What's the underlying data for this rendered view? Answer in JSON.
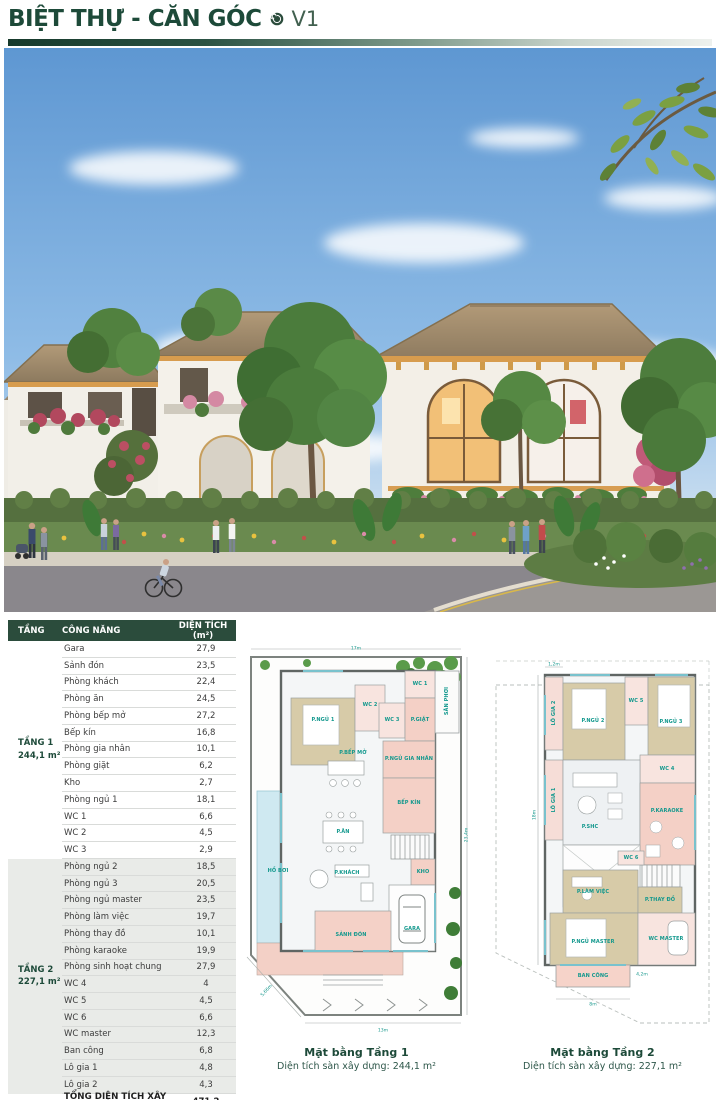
{
  "header": {
    "title": "BIỆT THỰ - CĂN GÓC",
    "version": "V1",
    "logo_icon": "spiral-icon"
  },
  "colors": {
    "brand_green": "#1d4a39",
    "table_header_bg": "#2b4c3c",
    "tang2_row_bg": "#e9ebe8",
    "plan_label_teal": "#12988d",
    "sky_blue": "#6ea6da"
  },
  "table": {
    "columns": [
      "TẦNG",
      "CÔNG NĂNG",
      "DIỆN TÍCH (m²)"
    ],
    "groups": [
      {
        "label": "TẦNG 1",
        "area": "244,1 m²",
        "rows": [
          [
            "Gara",
            "27,9"
          ],
          [
            "Sảnh đón",
            "23,5"
          ],
          [
            "Phòng khách",
            "22,4"
          ],
          [
            "Phòng ăn",
            "24,5"
          ],
          [
            "Phòng bếp mở",
            "27,2"
          ],
          [
            "Bếp kín",
            "16,8"
          ],
          [
            "Phòng gia nhân",
            "10,1"
          ],
          [
            "Phòng giặt",
            "6,2"
          ],
          [
            "Kho",
            "2,7"
          ],
          [
            "Phòng ngủ 1",
            "18,1"
          ],
          [
            "WC 1",
            "6,6"
          ],
          [
            "WC 2",
            "4,5"
          ],
          [
            "WC 3",
            "2,9"
          ]
        ]
      },
      {
        "label": "TẦNG 2",
        "area": "227,1 m²",
        "rows": [
          [
            "Phòng ngủ 2",
            "18,5"
          ],
          [
            "Phòng ngủ 3",
            "20,5"
          ],
          [
            "Phòng ngủ master",
            "23,5"
          ],
          [
            "Phòng làm việc",
            "19,7"
          ],
          [
            "Phòng thay đồ",
            "10,1"
          ],
          [
            "Phòng karaoke",
            "19,9"
          ],
          [
            "Phòng sinh hoạt chung",
            "27,9"
          ],
          [
            "WC 4",
            "4"
          ],
          [
            "WC 5",
            "4,5"
          ],
          [
            "WC 6",
            "6,6"
          ],
          [
            "WC master",
            "12,3"
          ],
          [
            "Ban công",
            "6,8"
          ],
          [
            "Lô gia 1",
            "4,8"
          ],
          [
            "Lô gia 2",
            "4,3"
          ]
        ]
      }
    ],
    "totals": [
      {
        "label": "TỔNG DIỆN TÍCH XÂY DỰNG",
        "value": "471,2"
      },
      {
        "label": "DIỆN TÍCH ĐẤT",
        "value": "495,5"
      }
    ]
  },
  "plans": [
    {
      "caption": "Mặt bằng Tầng 1",
      "subtitle": "Diện tích sàn xây dựng: 244,1 m²",
      "rooms": [
        "P.NGỦ 1",
        "WC 2",
        "WC 1",
        "SÂN PHƠI",
        "WC 3",
        "P.GIẶT",
        "P.NGỦ GIA NHÂN",
        "P.BẾP MỞ",
        "BẾP KÍN",
        "P.ĂN",
        "HỒ BƠI",
        "P.KHÁCH",
        "KHO",
        "GARA",
        "SẢNH ĐÓN"
      ],
      "dims": [
        "17m",
        "23,4m",
        "13m",
        "5,66m"
      ]
    },
    {
      "caption": "Mặt bằng Tầng 2",
      "subtitle": "Diện tích sàn xây dựng: 227,1 m²",
      "rooms": [
        "LÔ GIA 2",
        "P.NGỦ 2",
        "WC 5",
        "P.NGỦ 3",
        "WC 4",
        "LÔ GIA 1",
        "P.SHC",
        "P.KARAOKE",
        "P.LÀM VIỆC",
        "WC 6",
        "P.THAY ĐỒ",
        "P.NGỦ MASTER",
        "WC MASTER",
        "BAN CÔNG"
      ],
      "dims": [
        "1,2m",
        "18m",
        "8m",
        "4,2m"
      ]
    }
  ]
}
